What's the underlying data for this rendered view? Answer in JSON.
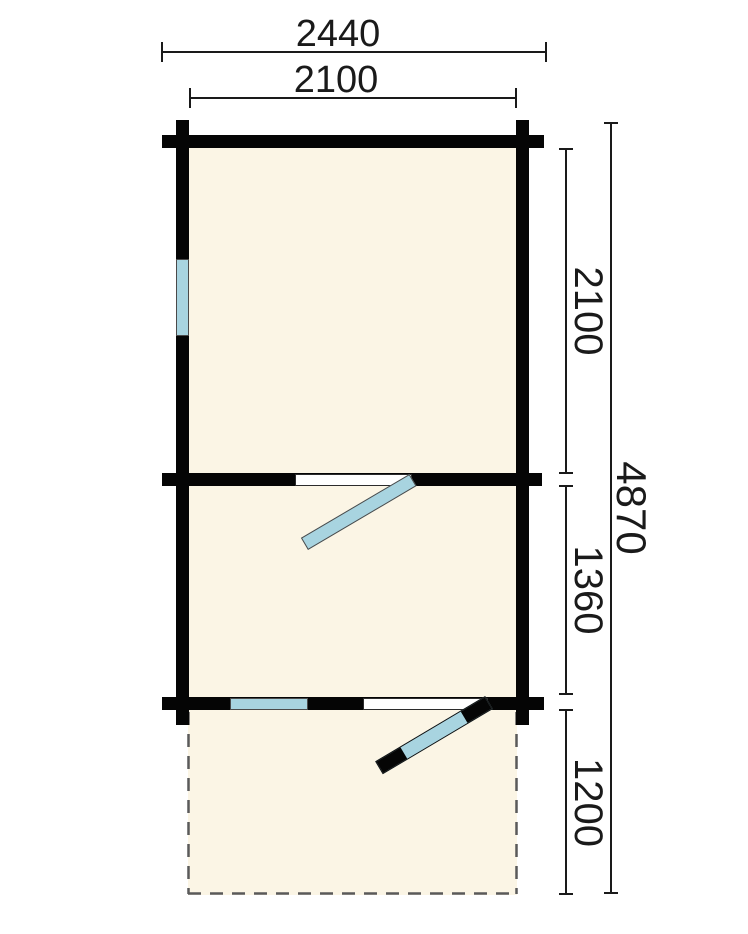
{
  "floor_plan": {
    "dimensions": {
      "overall_width_mm": "2440",
      "inner_width_mm": "2100",
      "main_room_depth_mm": "2100",
      "middle_room_depth_mm": "1360",
      "terrace_depth_mm": "1200",
      "overall_depth_mm": "4870"
    },
    "features": {
      "windows": [
        "left-wall-window",
        "front-wall-window"
      ],
      "doors": [
        "interior-door",
        "front-door"
      ],
      "terrace_outline": "dashed"
    },
    "colors": {
      "wall": "#050505",
      "floor": "#fbf5e5",
      "window_glass": "#a8d4e0",
      "terrace_dash": "#5a5a5a",
      "dimension_ink": "#1a1a1a",
      "background": "#ffffff"
    }
  }
}
